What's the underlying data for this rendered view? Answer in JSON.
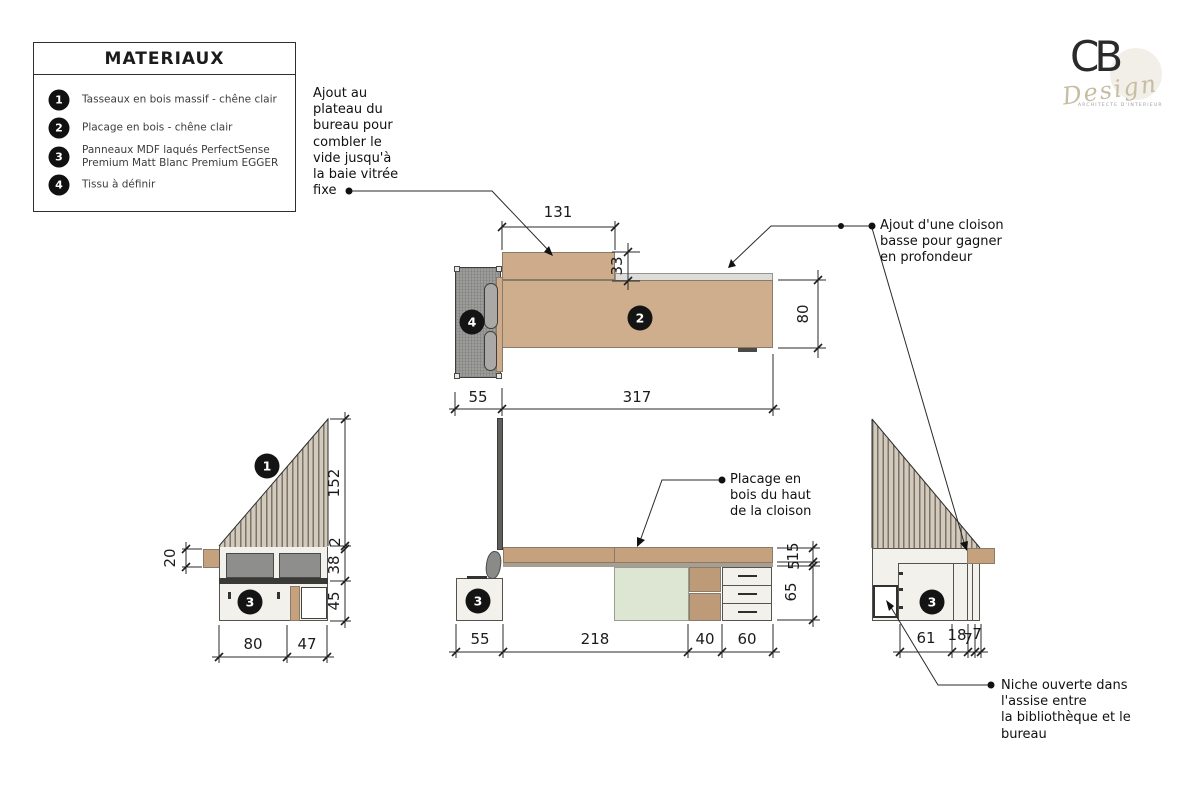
{
  "legend": {
    "title": "MATERIAUX",
    "items": [
      {
        "num": "1",
        "text": "Tasseaux en bois massif - chêne clair"
      },
      {
        "num": "2",
        "text": "Placage en bois - chêne clair"
      },
      {
        "num": "3",
        "text": "Panneaux MDF laqués PerfectSense Premium Matt Blanc Premium EGGER"
      },
      {
        "num": "4",
        "text": "Tissu à définir"
      }
    ]
  },
  "logo": {
    "monogram": "CB",
    "word": "Design",
    "tagline": "ARCHITECTE D'INTERIEUR"
  },
  "annotations": {
    "top_left": "Ajout au\nplateau du\nbureau pour\ncombler le\nvide jusqu'à\nla baie vitrée\nfixe",
    "top_right": "Ajout d'une cloison\nbasse pour gagner\nen profondeur",
    "mid": "Placage en\nbois du haut\nde la cloison",
    "bottom_right": "Niche ouverte dans\nl'assise entre\nla bibliothèque et le\nbureau"
  },
  "markers": {
    "plan_desk": "2",
    "plan_chair": "4",
    "left_slats": "1",
    "left_cabinet": "3",
    "center_cabinet": "3",
    "right_cabinet": "3"
  },
  "dims": {
    "plan": {
      "ext_width": "131",
      "notch": "33",
      "depth": "80",
      "chair": "55",
      "length": "317"
    },
    "left": {
      "block": "20",
      "slats": "152",
      "gap": "2",
      "seat": "38",
      "base": "45",
      "w1": "80",
      "w2": "47"
    },
    "center": {
      "chair": "55",
      "span": "218",
      "niche": "40",
      "drawers": "60",
      "top": "15",
      "strip": "5",
      "height": "65"
    },
    "right": {
      "w1": "61",
      "w2": "18",
      "w3": "7",
      "w4": "7"
    }
  },
  "colors": {
    "wood": "#cdab8b",
    "panel": "#f3f1ec",
    "green": "#dde6d3",
    "chair_gray": "#9c9c9a",
    "marker": "#141414"
  }
}
